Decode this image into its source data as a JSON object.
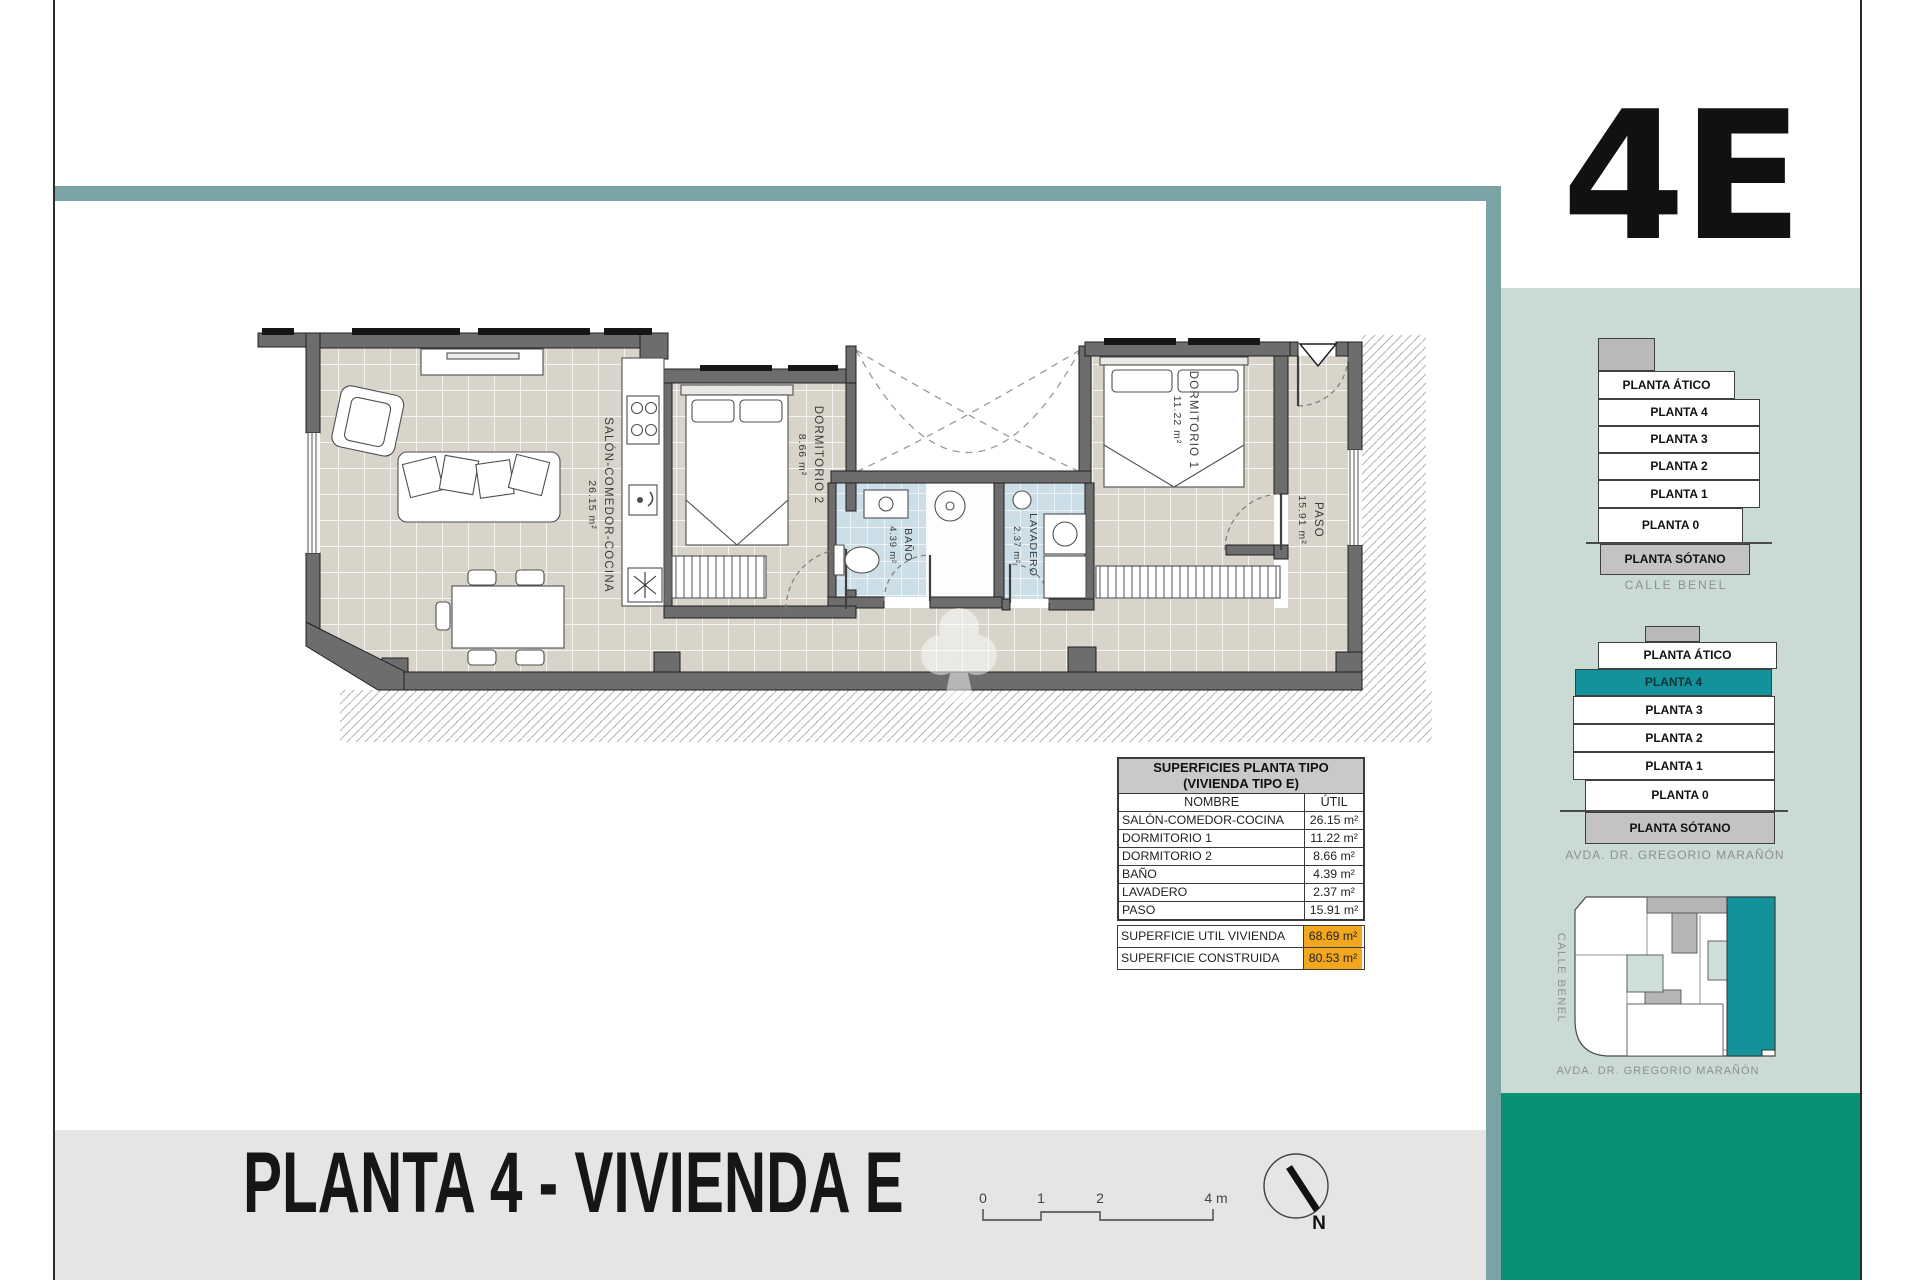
{
  "unit_code": "4E",
  "page_title": "PLANTA 4 - VIVIENDA E",
  "table": {
    "title_line1": "SUPERFICIES PLANTA TIPO",
    "title_line2": "(VIVIENDA TIPO E)",
    "col_name": "NOMBRE",
    "col_util": "ÚTIL",
    "rows": [
      {
        "name": "SALÓN-COMEDOR-COCINA",
        "util": "26.15 m²"
      },
      {
        "name": "DORMITORIO 1",
        "util": "11.22 m²"
      },
      {
        "name": "DORMITORIO 2",
        "util": "8.66 m²"
      },
      {
        "name": "BAÑO",
        "util": "4.39 m²"
      },
      {
        "name": "LAVADERO",
        "util": "2.37 m²"
      },
      {
        "name": "PASO",
        "util": "15.91 m²"
      }
    ],
    "summary": [
      {
        "label": "SUPERFICIE UTIL VIVIENDA",
        "value": "68.69 m²"
      },
      {
        "label": "SUPERFICIE CONSTRUIDA",
        "value": "80.53 m²"
      }
    ]
  },
  "floors": {
    "labels": [
      "PLANTA ÁTICO",
      "PLANTA 4",
      "PLANTA 3",
      "PLANTA 2",
      "PLANTA 1",
      "PLANTA 0",
      "PLANTA SÓTANO"
    ],
    "highlighted": "PLANTA 4",
    "street_side": "CALLE BENEL",
    "street_front": "AVDA. DR. GREGORIO MARAÑÓN"
  },
  "plan": {
    "rooms": {
      "salon": {
        "name": "SALÓN-COMEDOR-COCINA",
        "area": "26.15 m²"
      },
      "dorm1": {
        "name": "DORMITORIO 1",
        "area": "11.22 m²"
      },
      "dorm2": {
        "name": "DORMITORIO 2",
        "area": "8.66 m²"
      },
      "bano": {
        "name": "BAÑO",
        "area": "4.39 m²"
      },
      "lavadero": {
        "name": "LAVADERO",
        "area": "2.37 m²"
      },
      "paso": {
        "name": "PASO",
        "area": "15.91 m²"
      }
    }
  },
  "scale_bar": {
    "t0": "0",
    "t1": "1",
    "t2": "2",
    "t4": "4 m"
  },
  "north": {
    "label": "N"
  },
  "colors": {
    "teal_band": "#7aa3a5",
    "sidebar_green": "#c9dbd3",
    "accent_teal": "#14929b",
    "dark_green": "#0a9173",
    "highlight_orange": "#f2a71f"
  }
}
